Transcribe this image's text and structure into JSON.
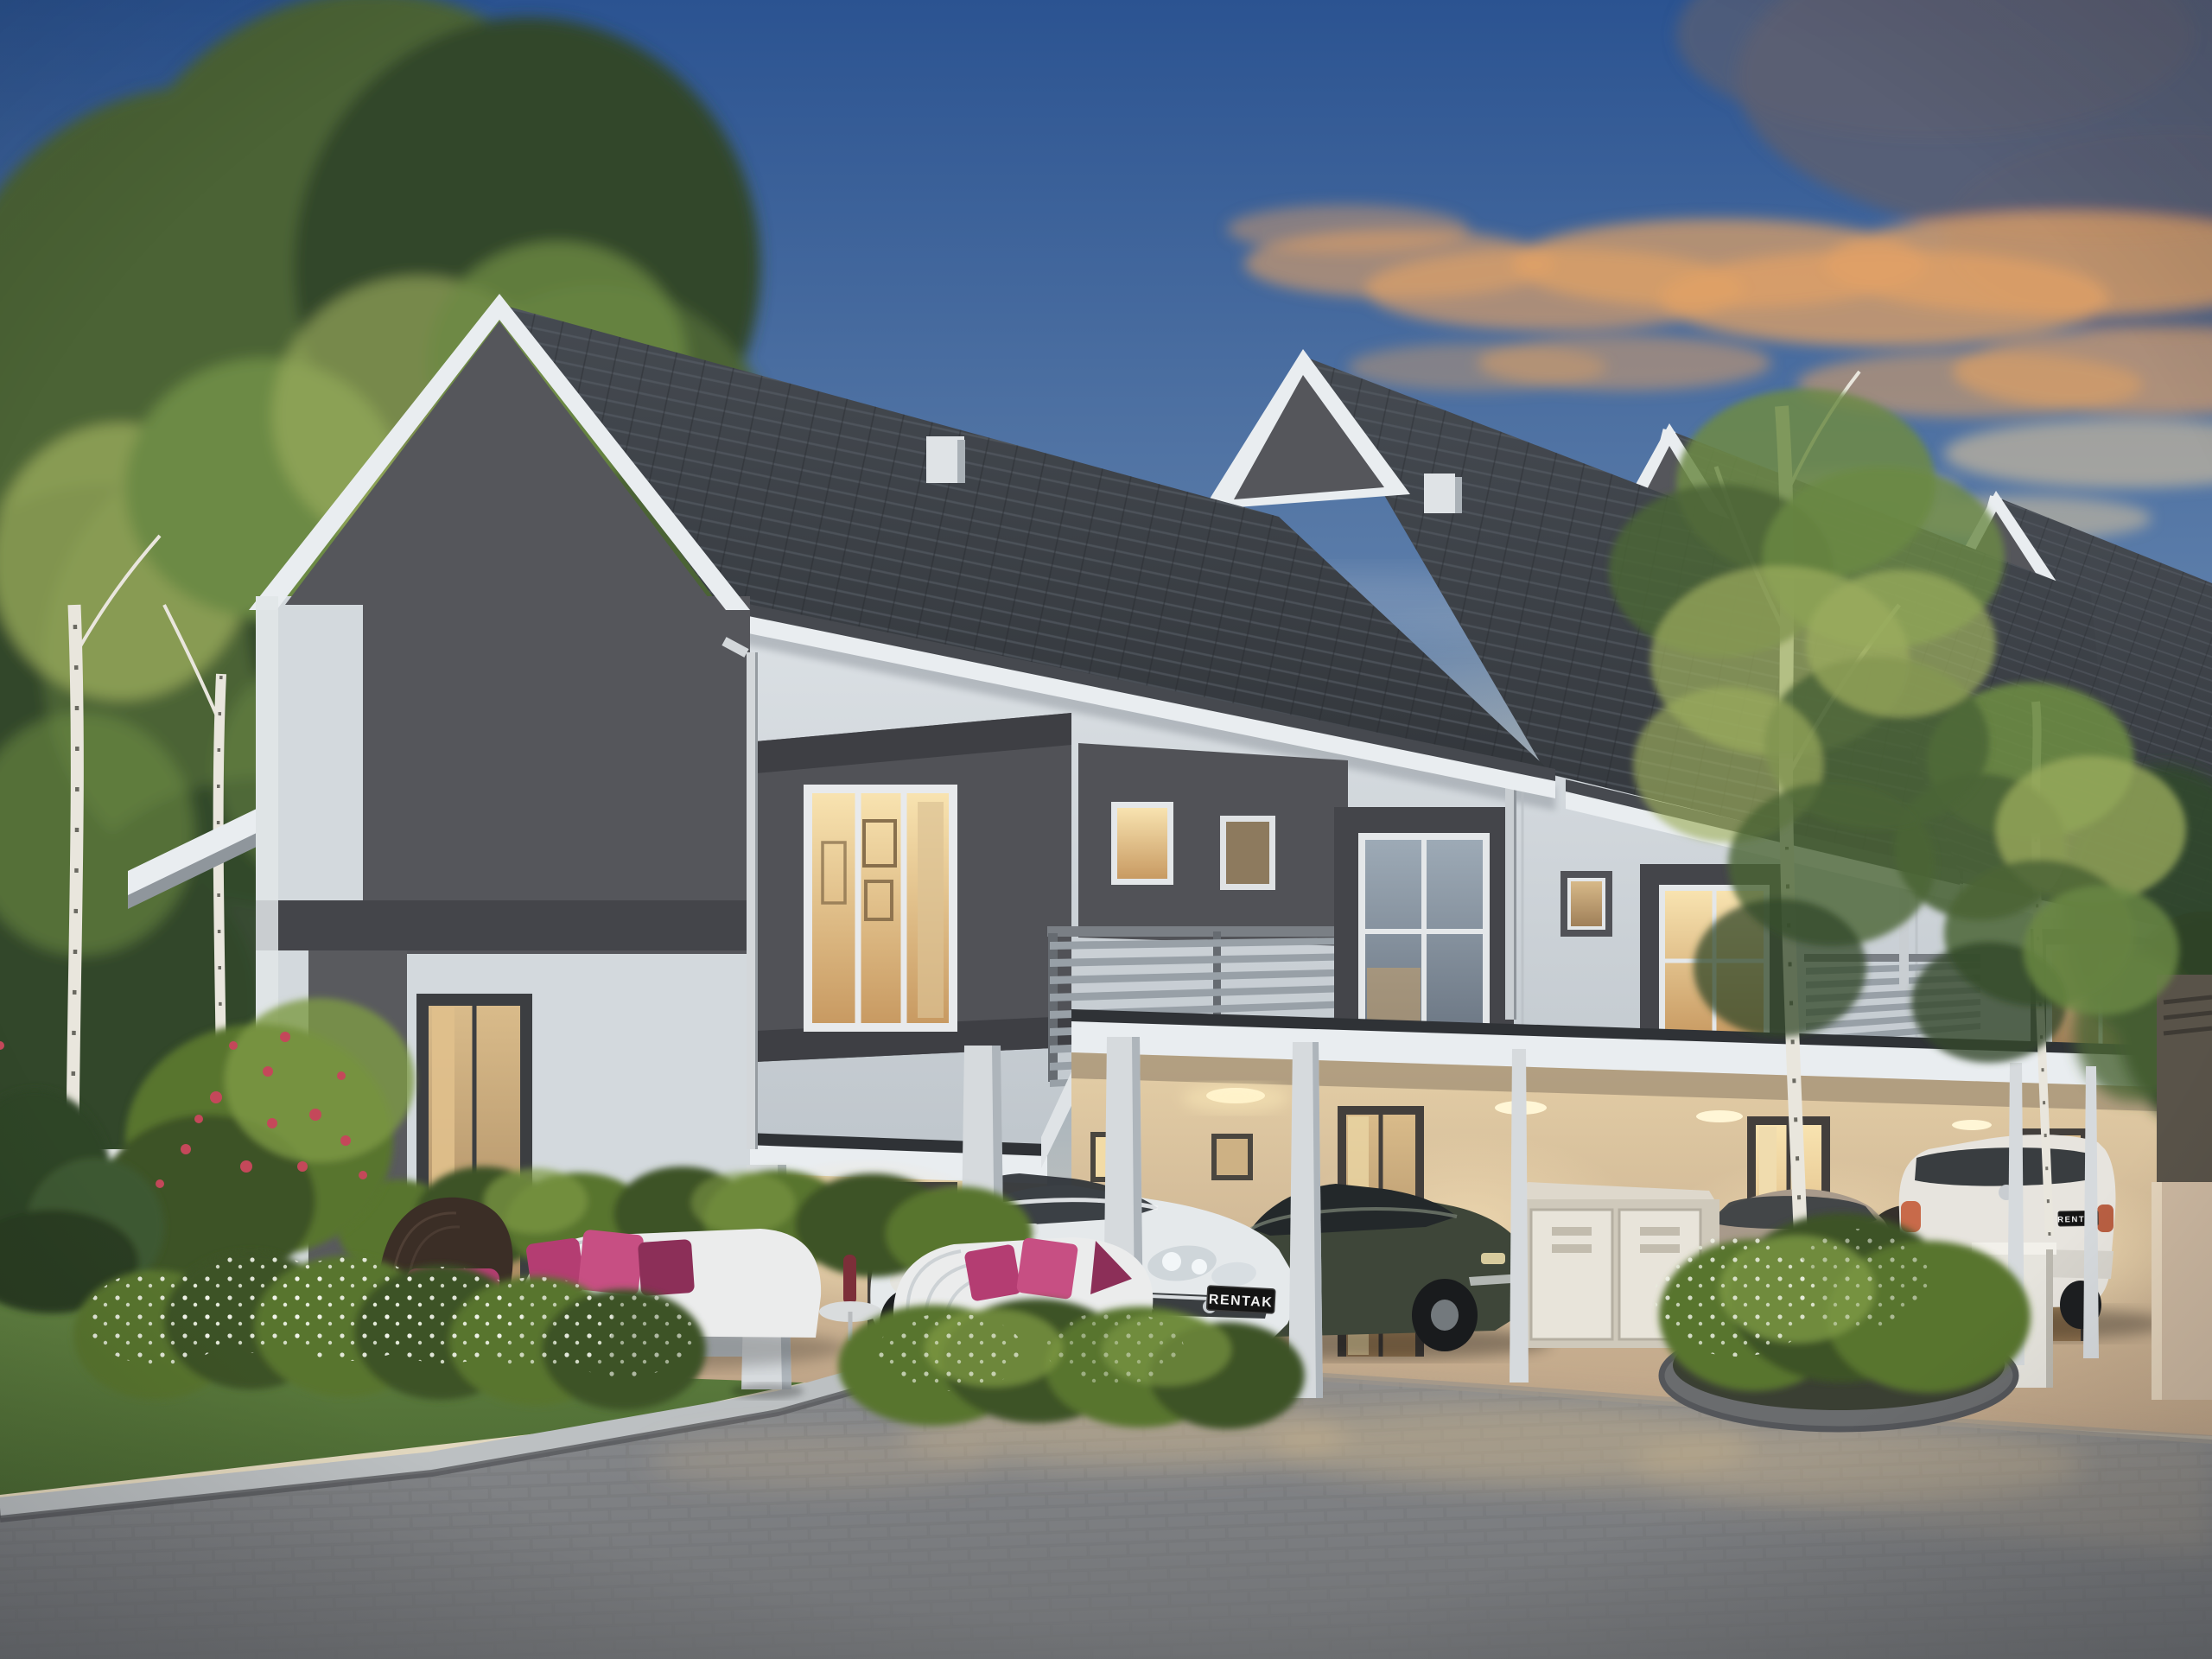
{
  "scene": {
    "title": "3D architectural rendering of modern two-storey terrace houses at dusk with carports, parked cars, landscaped garden and outdoor furniture",
    "license_plates": {
      "white_hatchback": "RENTAK",
      "bronze_sedan": "RENTAK",
      "white_suv": "RENTAK"
    }
  },
  "colors": {
    "sky_top": "#2b5391",
    "sky_mid": "#5f80ab",
    "sky_low": "#a9b4bd",
    "sky_horizon": "#e9dcbf",
    "cloud_pink": "#c68e7c",
    "cloud_orange": "#e2a265",
    "cloud_dark": "#5c5f72",
    "cloud_cream": "#f3d29c",
    "roof_dark": "#3a3e44",
    "fascia": "#e9edf0",
    "gutter": "#46494f",
    "wall_light": "#d3d9dd",
    "wall_mid": "#c0c7cd",
    "gable_dark": "#55565b",
    "box_dark": "#515257",
    "frame_dark": "#3e3f44",
    "trim_dark": "#44454a",
    "carport_warm": "#e4cea6",
    "carport_deep": "#bda387",
    "window_glow": "#f2d59e",
    "window_glow_deep": "#c89a62",
    "glass_dusk": "#8695a3",
    "column": "#d6dadd",
    "column_shade": "#aeb5bb",
    "slat": "#98a0a7",
    "hedge_dark": "#3c5226",
    "hedge_mid": "#59742f",
    "hedge_light": "#7d9a43",
    "grass_light": "#6d8f49",
    "grass_dark": "#4c6a33",
    "tree_dark": "#32472a",
    "tree_mid": "#4b6436",
    "tree_light": "#6c8a44",
    "tree_yellow": "#9cae5e",
    "birch": "#e9e6dd",
    "road": "#85878a",
    "road_dark": "#717376",
    "road_warm": "#a29786",
    "kerb_light": "#bcc0c2",
    "kerb_dark": "#56585b",
    "car_white": "#e5e9eb",
    "car_dark_olive": "#3e4639",
    "car_bronze": "#a89a8b",
    "car_suv_white": "#e7e4de",
    "cushion": "#b43d72",
    "cushion_deep": "#8c2f58",
    "cushion_bright": "#c74f83",
    "wicker": "#3b2e26",
    "bench": "#ebecec",
    "plate_bg": "#141414",
    "plate_text": "#f0f0f0",
    "vase_red": "#7c2f39"
  }
}
